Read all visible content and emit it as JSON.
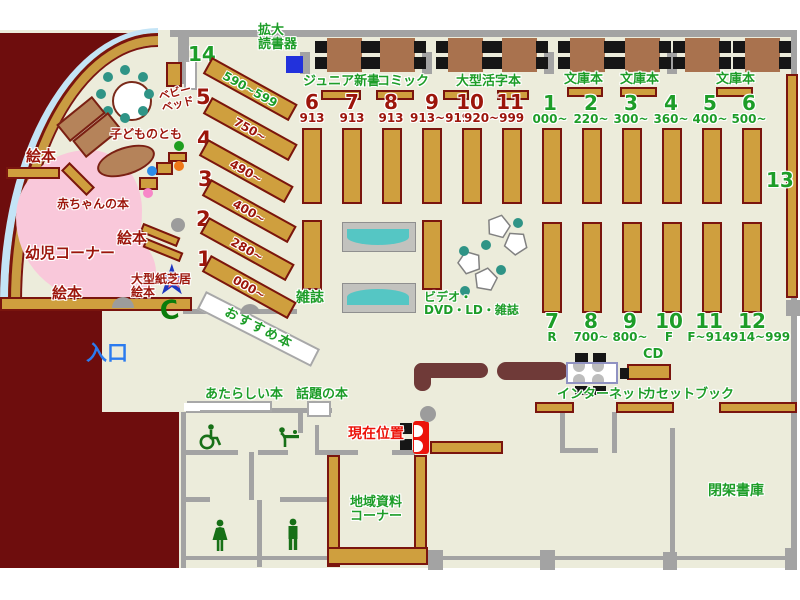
{
  "colors": {
    "floor": "#ECECDB",
    "shelf": "#CF9F3E",
    "shelf_border": "#7A150E",
    "wall": "#A3A3A3",
    "maroon_area": "#6E0D0D",
    "infant_pink": "#F9C8DA",
    "teal": "#2F9486",
    "green_text": "#1D9D28",
    "dark_red_text": "#9C150B",
    "bright_red_text": "#EC130A",
    "blue_text": "#2B7BEF",
    "table_brown": "#A9724E",
    "counter_brown": "#6F3A38",
    "window_blue": "#C4E4F6",
    "rack_teal": "#55C6C4",
    "device_blue": "#2231DC"
  },
  "labels": {
    "magnifier": "拡大\n読書器",
    "junior_shinsho": "ジュニア新書",
    "comic": "コミック",
    "large_print": "大型活字本",
    "bunko_1": "文庫本",
    "bunko_2": "文庫本",
    "bunko_3": "文庫本",
    "magazines": "雑誌",
    "video": "ビデオ・\nDVD・LD・雑誌",
    "recommended": "おすすめ本",
    "new_books": "あたらしい本",
    "topical_books": "話題の本",
    "current_position": "現在位置",
    "local_materials": "地域資料\nコーナー",
    "closed_stacks": "閉架書庫",
    "cd": "CD",
    "internet": "インターネット",
    "cassette_books": "カセットブック",
    "entrance": "入口",
    "baby_bed": "ベビー\nベッド",
    "kodomo_no_tomo": "子どものとも",
    "infant_corner": "幼児コーナー",
    "baby_books": "赤ちゃんの本",
    "picture_books_1": "絵本",
    "picture_books_2": "絵本",
    "picture_books_3": "絵本",
    "large_kamishibai": "大型紙芝居\n絵本",
    "shelf_13": "13"
  },
  "diagonal_shelves": [
    {
      "no": "14",
      "range": "590~599",
      "tone": "green"
    },
    {
      "no": "5",
      "range": "750~",
      "tone": "red"
    },
    {
      "no": "4",
      "range": "490~",
      "tone": "red"
    },
    {
      "no": "3",
      "range": "400~",
      "tone": "red"
    },
    {
      "no": "2",
      "range": "280~",
      "tone": "red"
    },
    {
      "no": "1",
      "range": "000~",
      "tone": "red"
    }
  ],
  "rows": {
    "red": [
      {
        "no": "6",
        "range": "913"
      },
      {
        "no": "7",
        "range": "913"
      },
      {
        "no": "8",
        "range": "913"
      },
      {
        "no": "9",
        "range": "913~919"
      },
      {
        "no": "10",
        "range": "920~999"
      },
      {
        "no": "11",
        "range": ""
      }
    ],
    "green_top": [
      {
        "no": "1",
        "range": "000~"
      },
      {
        "no": "2",
        "range": "220~"
      },
      {
        "no": "3",
        "range": "300~"
      },
      {
        "no": "4",
        "range": "360~"
      },
      {
        "no": "5",
        "range": "400~"
      },
      {
        "no": "6",
        "range": "500~"
      }
    ],
    "green_bottom": [
      {
        "no": "7",
        "range": "R"
      },
      {
        "no": "8",
        "range": "700~"
      },
      {
        "no": "9",
        "range": "800~"
      },
      {
        "no": "10",
        "range": "F"
      },
      {
        "no": "11",
        "range": "F~914"
      },
      {
        "no": "12",
        "range": "914~999"
      }
    ]
  }
}
